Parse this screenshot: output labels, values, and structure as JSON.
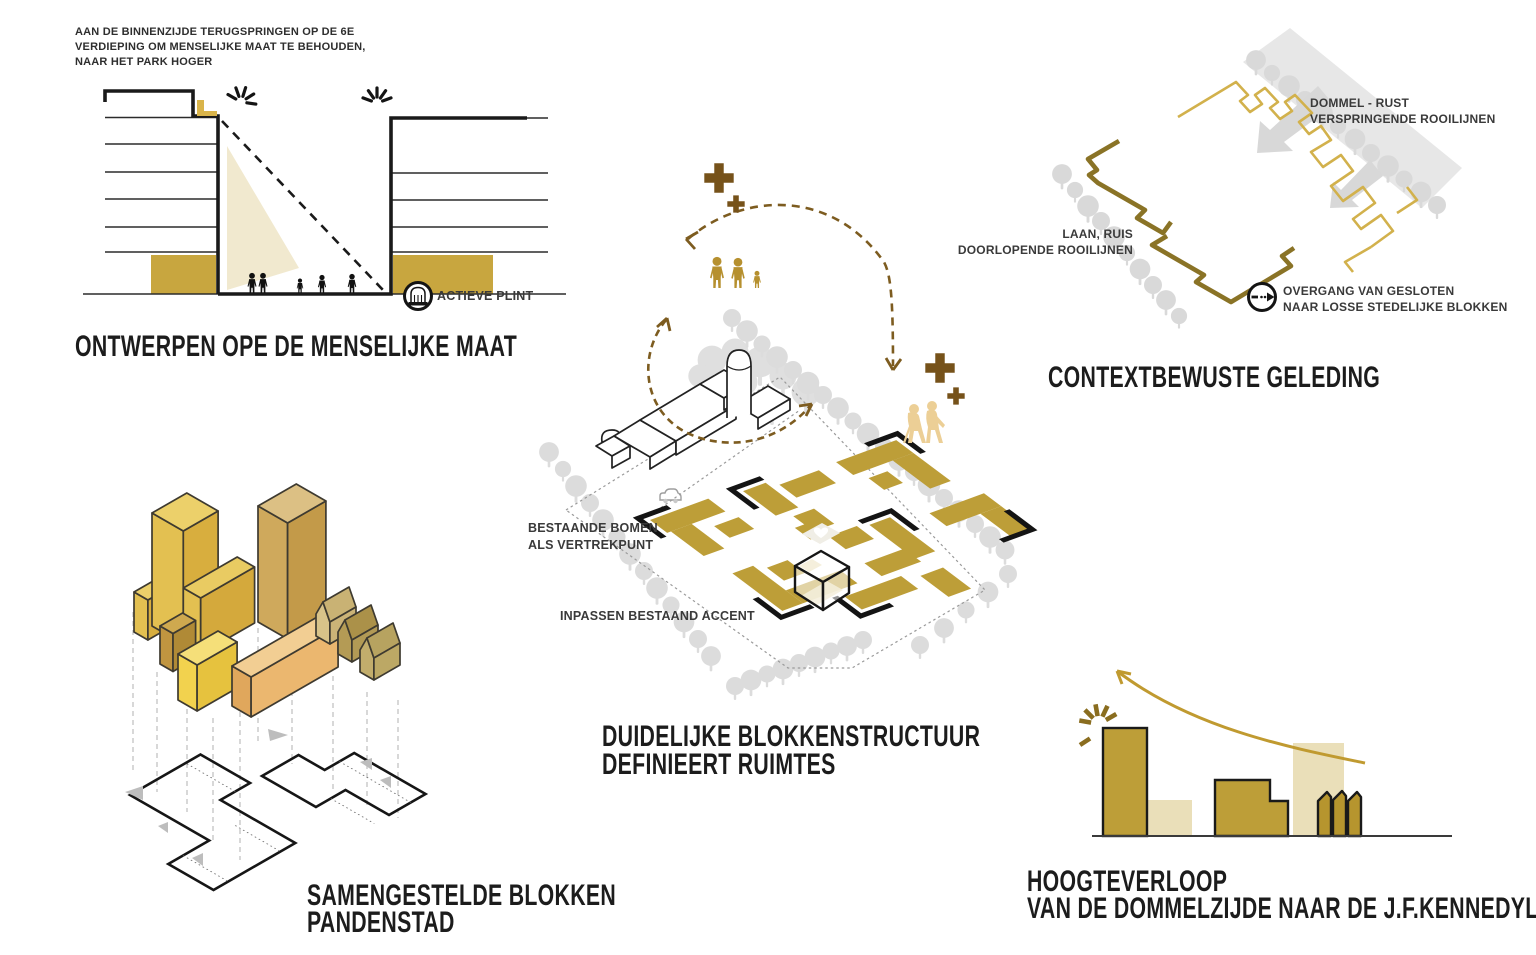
{
  "colors": {
    "gold": "#BD9E38",
    "gold_bright": "#C8A63F",
    "beige": "#EADFB9",
    "beige_light": "#F0E8CE",
    "brown_dark": "#76521A",
    "olive_line": "#8A7326",
    "gold_line": "#D2B14C",
    "family_gold": "#B6902F",
    "elderly_gold": "#ECCF96",
    "tree_gray": "#DCDCDC",
    "ink": "#1A1A1A"
  },
  "icons": {
    "actieve_plint_icon": "storefront-in-circle",
    "overgang_icon": "dashed-arrow-in-circle",
    "sparkle_icon": "emphasis-burst",
    "plus_icon": "plus-cross",
    "tree_icon": "canopy-circle"
  },
  "diagrams": {
    "menselijke_maat": {
      "annotation_line1": "AAN DE BINNENZIJDE TERUGSPRINGEN OP DE 6E",
      "annotation_line2": "VERDIEPING OM MENSELIJKE MAAT TE BEHOUDEN,",
      "annotation_line3": "NAAR HET PARK HOGER",
      "callout": "ACTIEVE PLINT",
      "title": "ONTWERPEN OPE DE MENSELIJKE MAAT"
    },
    "contextbewuste_geleding": {
      "dommel_line1": "DOMMEL - RUST",
      "dommel_line2": "VERSPRINGENDE ROOILIJNEN",
      "laan_line1": "LAAN, RUIS",
      "laan_line2": "DOORLOPENDE ROOILIJNEN",
      "overgang_line1": "OVERGANG VAN GESLOTEN",
      "overgang_line2": "NAAR LOSSE STEDELIJKE BLOKKEN",
      "title": "CONTEXTBEWUSTE GELEDING"
    },
    "blokkenstructuur": {
      "bomen_line1": "BESTAANDE BOMEN",
      "bomen_line2": "ALS VERTREKPUNT",
      "accent_label": "INPASSEN BESTAAND ACCENT",
      "title_line1": "DUIDELIJKE BLOKKENSTRUCTUUR",
      "title_line2": "DEFINIEERT RUIMTES"
    },
    "samengestelde_blokken": {
      "title_line1": "SAMENGESTELDE BLOKKEN",
      "title_line2": "PANDENSTAD"
    },
    "hoogteverloop": {
      "title_line1": "HOOGTEVERLOOP",
      "title_line2": "VAN DE DOMMELZIJDE NAAR DE J.F.KENNEDYLAAN"
    }
  }
}
